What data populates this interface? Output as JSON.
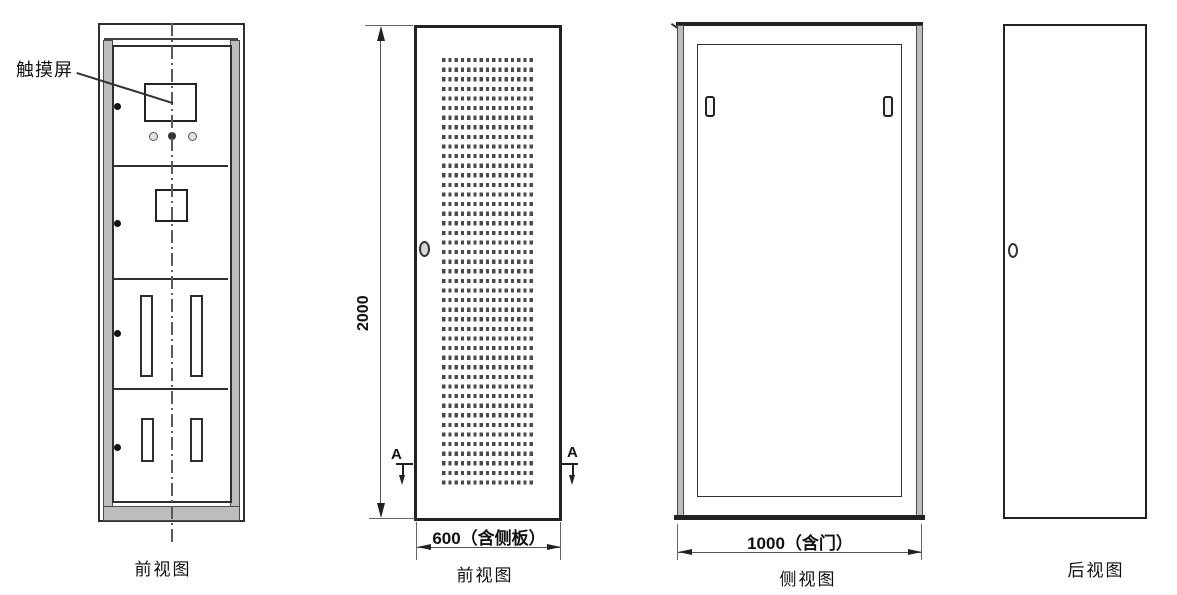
{
  "drawing": {
    "annotation": {
      "touch_screen": "触摸屏"
    },
    "cabinet_front": {
      "label": "前视图"
    },
    "door_front": {
      "label": "前视图",
      "height_dim": "2000",
      "width_dim": "600（含侧板）",
      "section_marker": "A"
    },
    "side_view": {
      "label": "侧视图",
      "width_dim": "1000（含门）"
    },
    "rear_view": {
      "label": "后视图"
    },
    "colors": {
      "line": "#2f2f2f",
      "panel_gray": "#bdbdbd",
      "background": "#ffffff",
      "perforation": "#4b4b4b"
    }
  }
}
